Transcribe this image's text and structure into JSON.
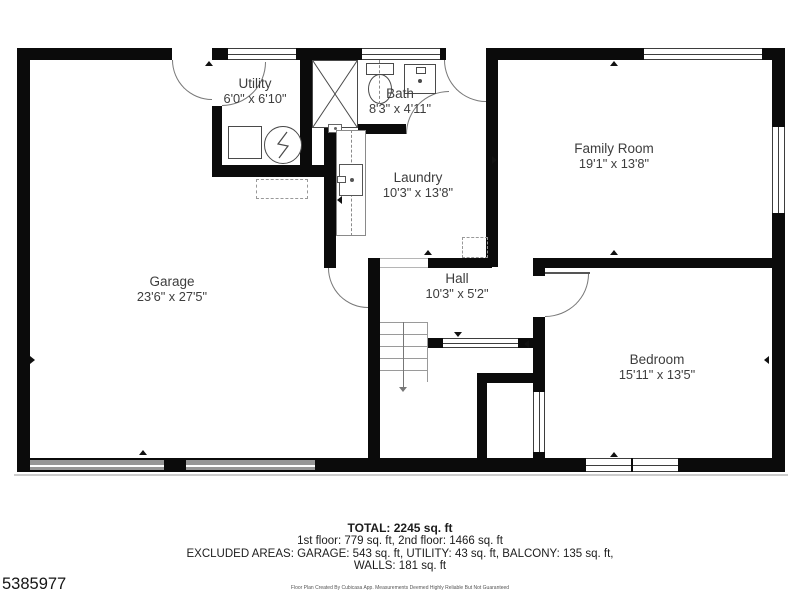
{
  "rooms": [
    {
      "name": "Utility",
      "dims": "6'0\" x 6'10\""
    },
    {
      "name": "Bath",
      "dims": "8'3\" x 4'11\""
    },
    {
      "name": "Laundry",
      "dims": "10'3\" x 13'8\""
    },
    {
      "name": "Family Room",
      "dims": "19'1\" x 13'8\""
    },
    {
      "name": "Garage",
      "dims": "23'6\" x 27'5\""
    },
    {
      "name": "Hall",
      "dims": "10'3\" x 5'2\""
    },
    {
      "name": "Bedroom",
      "dims": "15'11\" x 13'5\""
    }
  ],
  "footer": {
    "total": "TOTAL: 2245 sq. ft",
    "floors": "1st floor: 779 sq. ft, 2nd floor: 1466 sq. ft",
    "excluded": "EXCLUDED AREAS: GARAGE: 543 sq. ft, UTILITY: 43 sq. ft, BALCONY: 135 sq. ft,",
    "walls_line": "WALLS: 181 sq. ft",
    "disclaimer": "Floor Plan Created By Cubicasa App. Measurements Deemed Highly Reliable But Not Guaranteed",
    "listing_number": "5385977"
  },
  "fixtures": [
    "shower",
    "toilet",
    "bath-sink",
    "laundry-counter",
    "laundry-sink",
    "water-heater",
    "utility-appliance",
    "stairs-down",
    "garage-door",
    "window",
    "door"
  ],
  "colors": {
    "wall": "#0b0b0b",
    "window_frame": "#3d3d3d",
    "garage_door": "#979797",
    "door_arc": "#777777"
  }
}
